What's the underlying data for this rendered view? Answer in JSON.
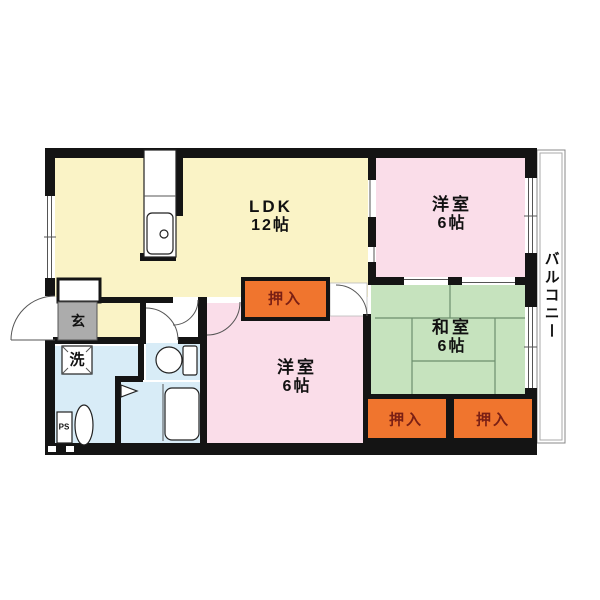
{
  "colors": {
    "wall": "#141414",
    "ldk": "#FAF3C6",
    "western-room": "#FADDE9",
    "japanese-room": "#C6E3BE",
    "wet-area": "#D8ECF7",
    "closet": "#F0752E",
    "closet-text": "#7A1F14",
    "entrance": "#ACACAC",
    "tatami-line": "#6D8F6D"
  },
  "rooms": {
    "ldk": {
      "name": "LDK",
      "size": "12帖"
    },
    "western_top": {
      "name": "洋室",
      "size": "6帖"
    },
    "japanese": {
      "name": "和室",
      "size": "6帖"
    },
    "western_bottom": {
      "name": "洋室",
      "size": "6帖"
    },
    "balcony": {
      "name": "バルコニー"
    },
    "entrance": {
      "label": "玄"
    },
    "laundry": {
      "label": "洗"
    },
    "pipe_shaft": {
      "label": "PS"
    },
    "closet_ldk": {
      "label": "押入"
    },
    "closet_left": {
      "label": "押入"
    },
    "closet_right": {
      "label": "押入"
    }
  }
}
